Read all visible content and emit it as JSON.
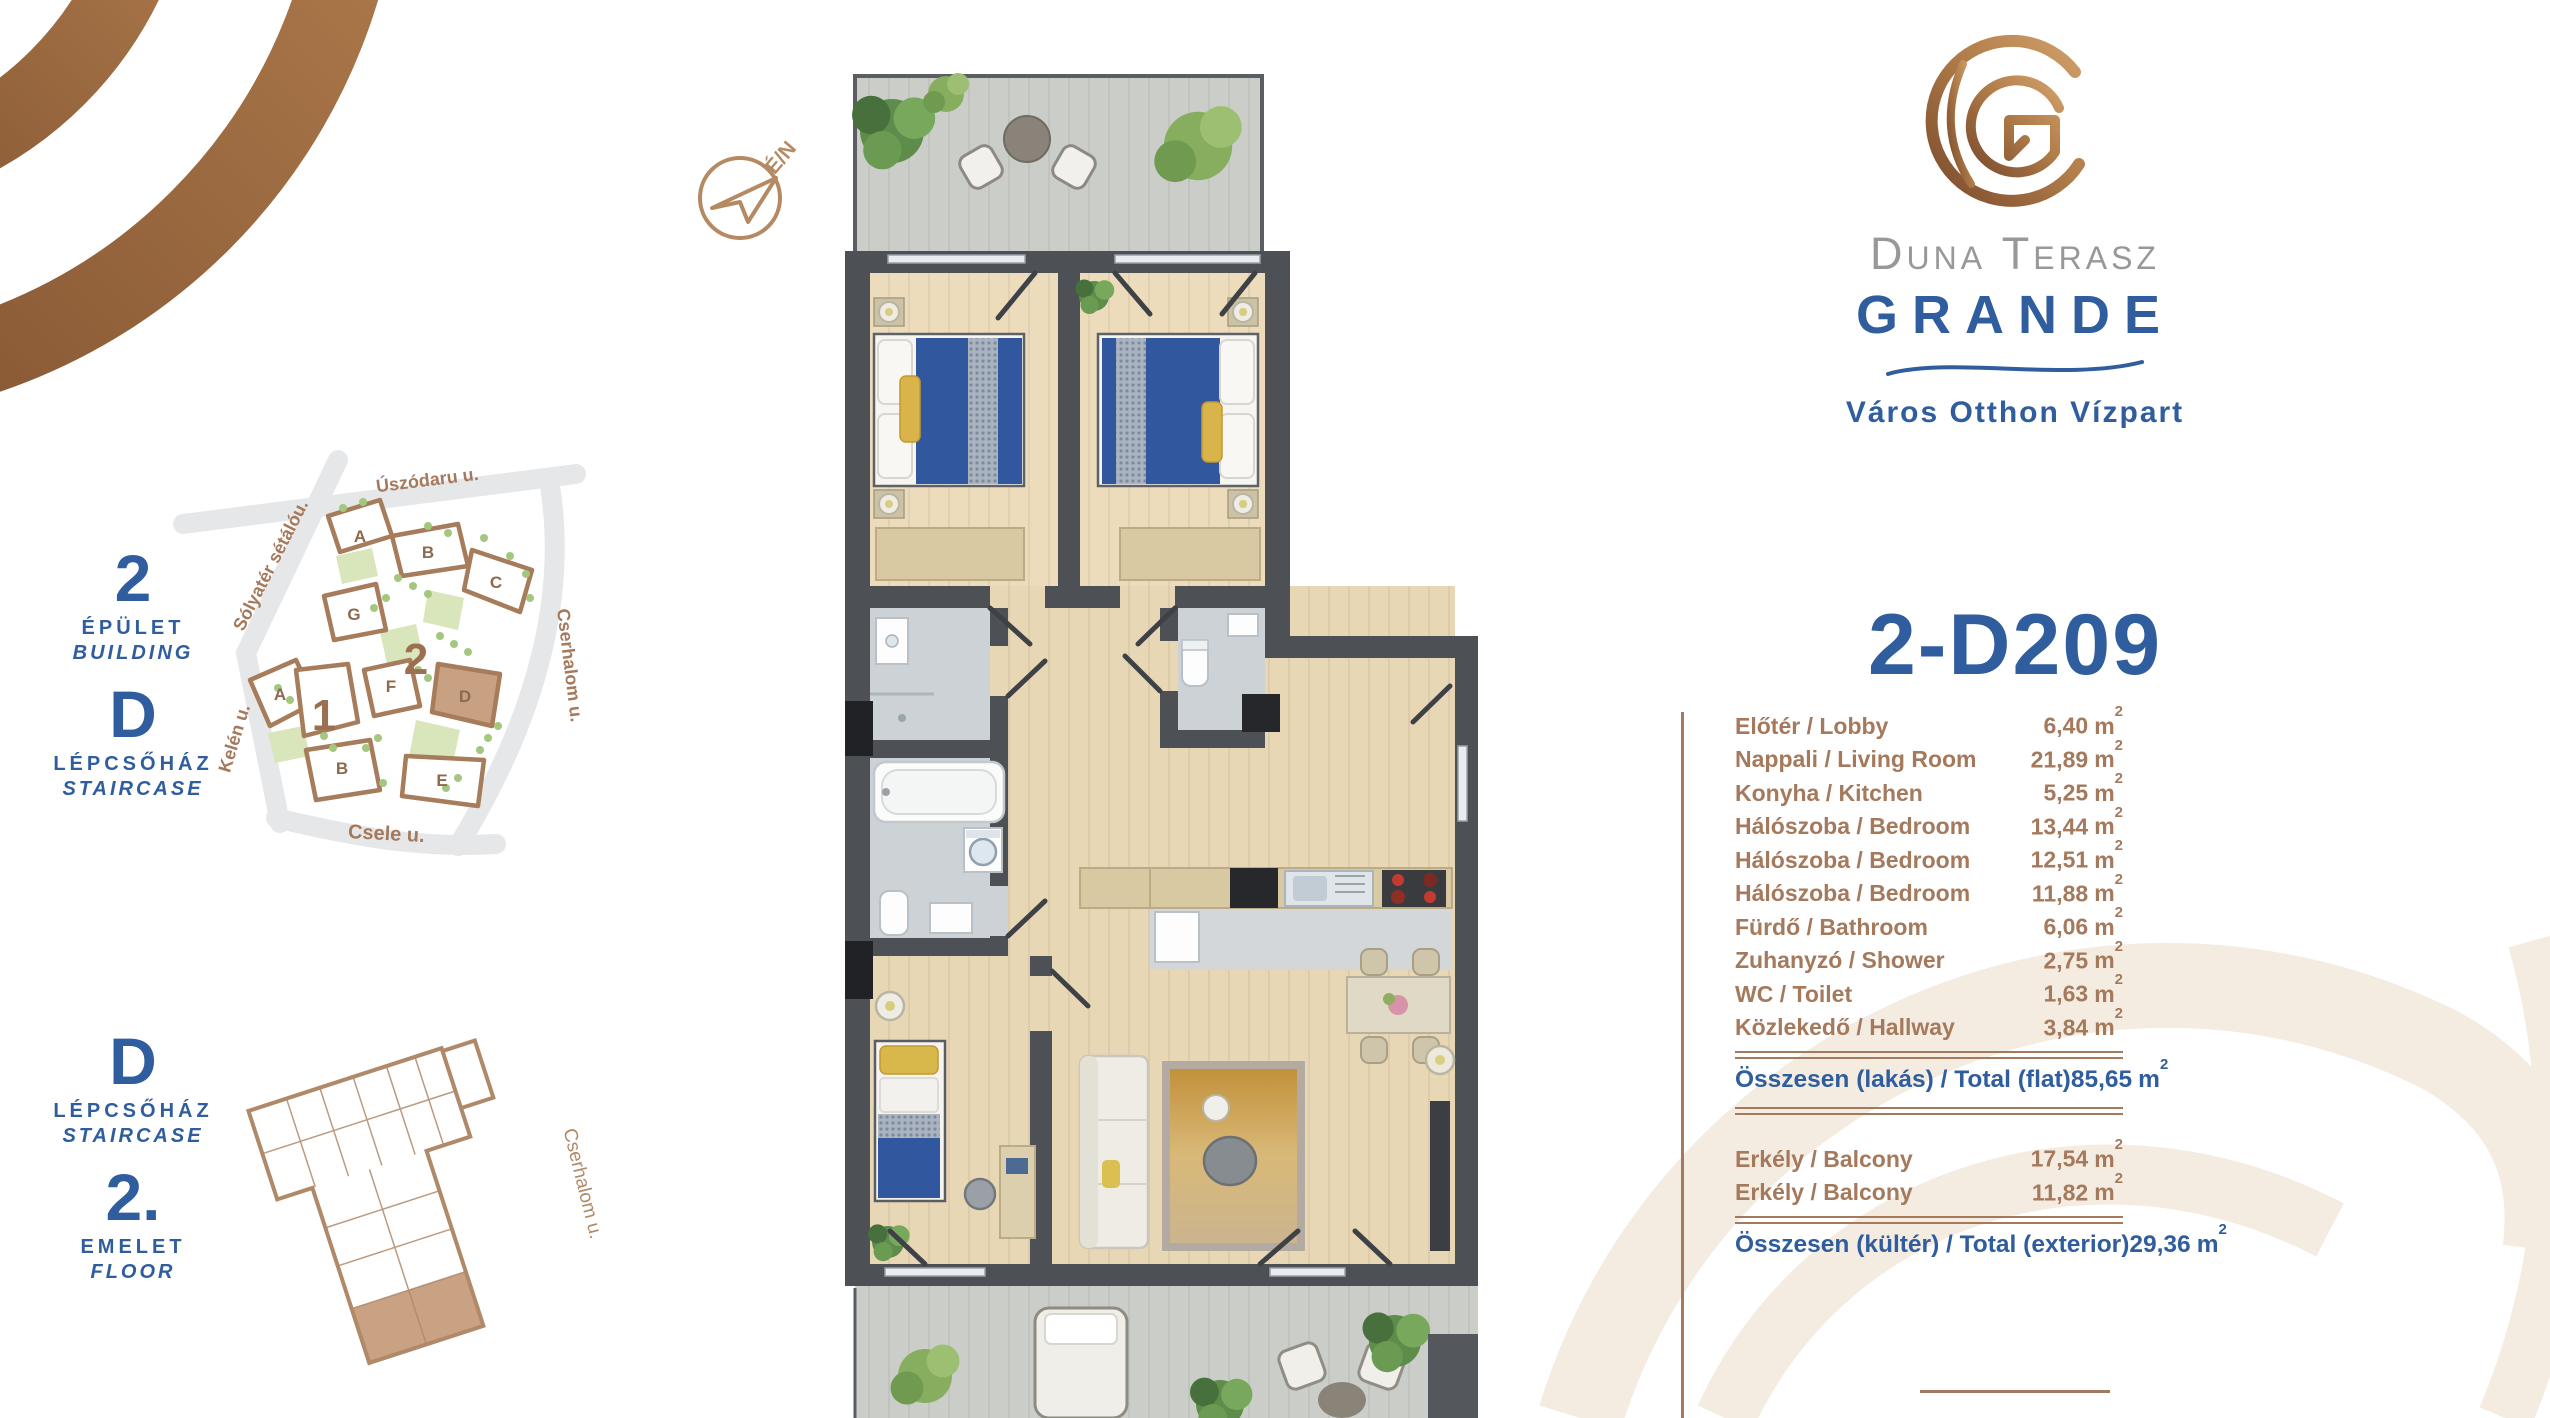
{
  "brand": {
    "monogram": "G",
    "name_line1": "Duna Terasz",
    "name_line2": "GRANDE",
    "tagline": "Város Otthon Vízpart"
  },
  "unit": {
    "title": "2-D209"
  },
  "compass": {
    "label": "É/N"
  },
  "location": {
    "building_number": "2",
    "building_label_hu": "ÉPÜLET",
    "building_label_en": "BUILDING",
    "staircase_letter": "D",
    "staircase_label_hu": "LÉPCSŐHÁZ",
    "staircase_label_en": "STAIRCASE",
    "floor_number": "2.",
    "floor_label_hu": "EMELET",
    "floor_label_en": "FLOOR"
  },
  "site_map": {
    "streets": [
      "Úszódaru u.",
      "Sólyatér sétálóu.",
      "Kelén u.",
      "Cserhalom u.",
      "Csele u."
    ],
    "building2_number": "2",
    "blocks_building2": [
      "A",
      "B",
      "C",
      "G",
      "F",
      "D",
      "E"
    ],
    "building1_number": "1",
    "blocks_building1": [
      "A",
      "B"
    ],
    "highlighted_block": "D"
  },
  "floor_thumbnail": {
    "street_label": "Cserhalom u."
  },
  "rooms": [
    {
      "label": "Előtér / Lobby",
      "area": "6,40"
    },
    {
      "label": "Nappali / Living Room",
      "area": "21,89"
    },
    {
      "label": "Konyha / Kitchen",
      "area": "5,25"
    },
    {
      "label": "Hálószoba / Bedroom",
      "area": "13,44"
    },
    {
      "label": "Hálószoba / Bedroom",
      "area": "12,51"
    },
    {
      "label": "Hálószoba / Bedroom",
      "area": "11,88"
    },
    {
      "label": "Fürdő / Bathroom",
      "area": "6,06"
    },
    {
      "label": "Zuhanyzó / Shower",
      "area": "2,75"
    },
    {
      "label": "WC / Toilet",
      "area": "1,63"
    },
    {
      "label": "Közlekedő / Hallway",
      "area": "3,84"
    }
  ],
  "totals": {
    "flat": {
      "label": "Összesen (lakás) / Total (flat)",
      "area": "85,65"
    },
    "balconies": [
      {
        "label": "Erkély / Balcony",
        "area": "17,54"
      },
      {
        "label": "Erkély / Balcony",
        "area": "11,82"
      }
    ],
    "exterior": {
      "label": "Összesen (kültér) / Total (exterior)",
      "area": "29,36"
    }
  },
  "area_unit": {
    "base": "m",
    "sup": "2"
  },
  "colors": {
    "accent_blue": "#2f5d9e",
    "table_brown": "#a5795c",
    "copper": "#b9835a",
    "map_green": "#a3c77f",
    "wall_gray": "#4d5055",
    "bed_blue": "#31589e",
    "wood": "#ecdcbc",
    "tile": "#ccd2d6"
  }
}
